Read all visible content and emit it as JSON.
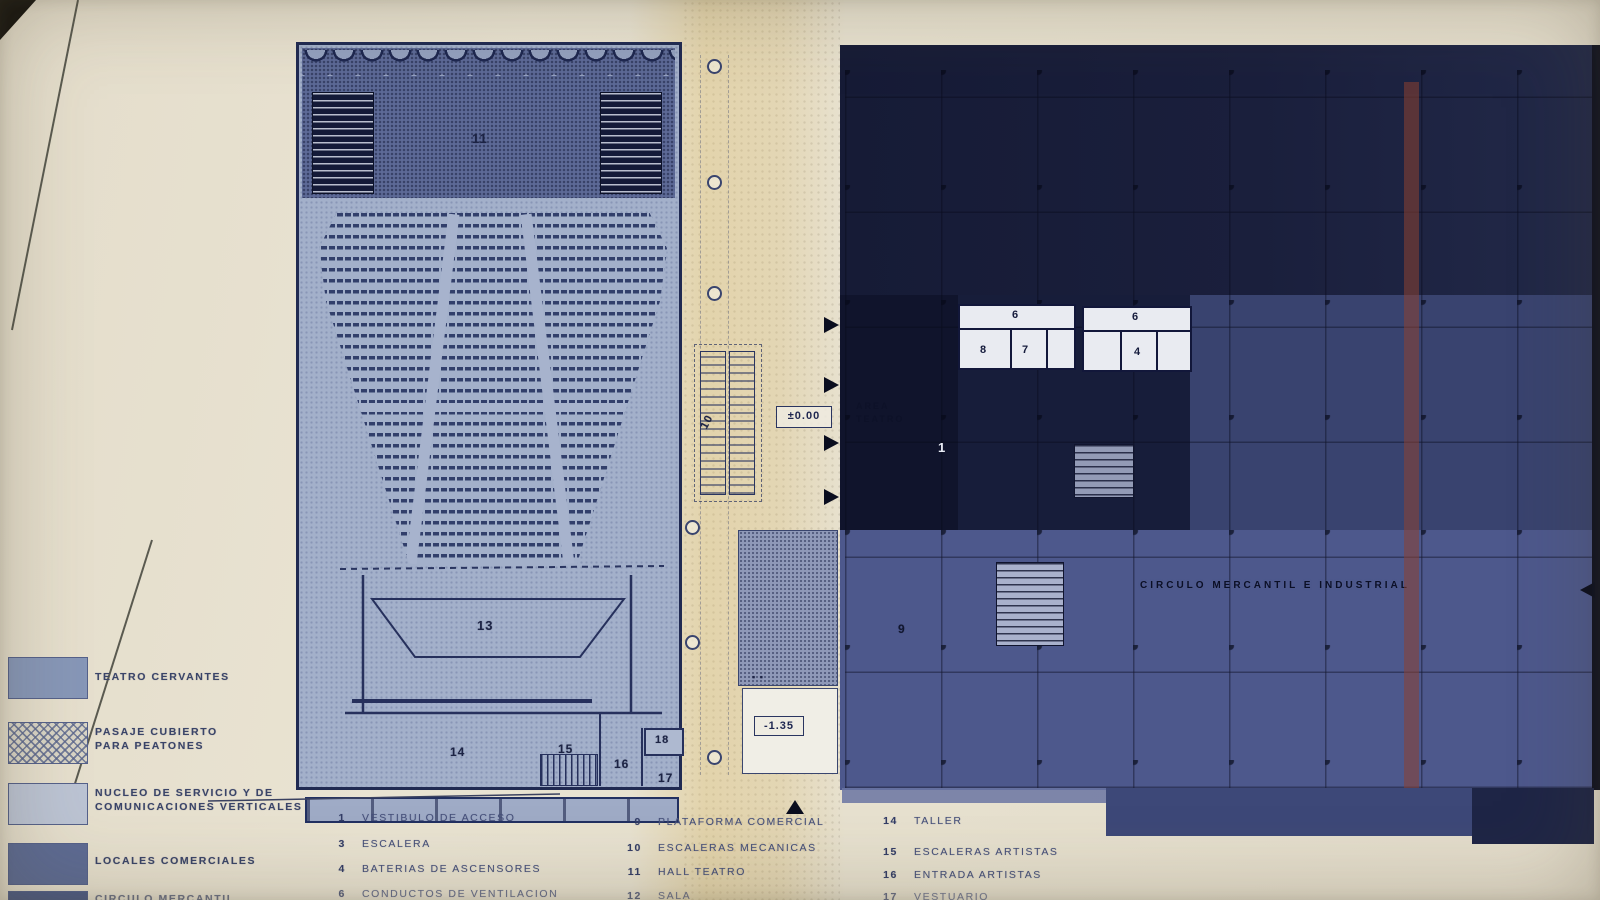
{
  "street": {
    "label": "PLAZA PABLO CAZARO"
  },
  "theater": {
    "hall": "11",
    "stage": "13",
    "room_14": "14",
    "room_15": "15",
    "room_16": "16",
    "room_17": "17",
    "room_18": "18"
  },
  "passage": {
    "escalator": "10",
    "level_zero": "±0.00",
    "level_lower": "-1.35"
  },
  "building": {
    "duct_a": "6",
    "duct_b": "6",
    "room_8": "8",
    "room_7": "7",
    "room_4": "4",
    "platform": "9",
    "lobby": "1",
    "area_line1": "AREA",
    "area_line2": "TEATRO",
    "name": "CIRCULO MERCANTIL E INDUSTRIAL"
  },
  "legend": {
    "items": [
      {
        "lines": [
          "TEATRO CERVANTES",
          ""
        ]
      },
      {
        "lines": [
          "PASAJE CUBIERTO",
          "PARA PEATONES"
        ]
      },
      {
        "lines": [
          "NUCLEO DE SERVICIO Y DE",
          "COMUNICACIONES VERTICALES"
        ]
      },
      {
        "lines": [
          "LOCALES COMERCIALES",
          ""
        ]
      },
      {
        "lines": [
          "CIRCULO MERCANTIL",
          ""
        ]
      }
    ]
  },
  "key": {
    "columns": [
      {
        "rows": [
          {
            "n": "1",
            "t": "VESTIBULO DE ACCESO"
          },
          {
            "n": "3",
            "t": "ESCALERA"
          },
          {
            "n": "4",
            "t": "BATERIAS DE ASCENSORES"
          },
          {
            "n": "6",
            "t": "CONDUCTOS DE VENTILACION"
          }
        ]
      },
      {
        "rows": [
          {
            "n": "9",
            "t": "PLATAFORMA COMERCIAL"
          },
          {
            "n": "10",
            "t": "ESCALERAS MECANICAS"
          },
          {
            "n": "11",
            "t": "HALL TEATRO"
          },
          {
            "n": "12",
            "t": "SALA"
          }
        ]
      },
      {
        "rows": [
          {
            "n": "14",
            "t": "TALLER"
          },
          {
            "n": "15",
            "t": "ESCALERAS ARTISTAS"
          },
          {
            "n": "16",
            "t": "ENTRADA ARTISTAS"
          },
          {
            "n": "17",
            "t": "VESTUARIO"
          }
        ]
      }
    ]
  },
  "colors": {
    "paper": "#e7e1d0",
    "theater_fill": "#a3b0ca",
    "outline": "#202a52",
    "building_dark": "#1a1f3c",
    "building_mid": "#4d588c",
    "red_stripe": "#7d4038"
  }
}
